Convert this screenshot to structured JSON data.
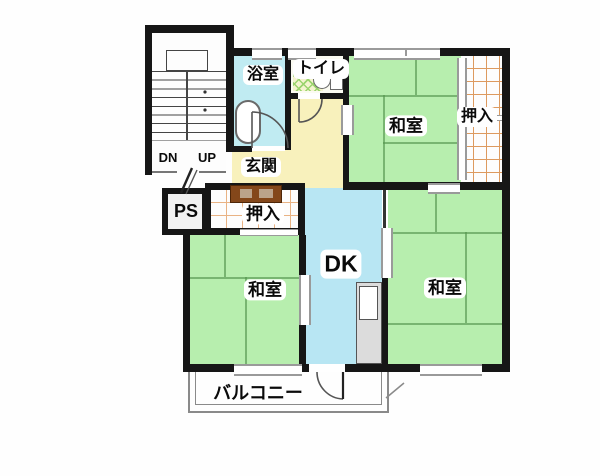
{
  "plan_title": "2DK apartment floor plan",
  "labels": {
    "bath": "浴室",
    "toilet": "トイレ",
    "washitsu_ne": "和室",
    "oshiire_ne": "押入",
    "genkan": "玄関",
    "dn": "DN",
    "up": "UP",
    "ps": "PS",
    "oshiire_mid": "押入",
    "dk": "DK",
    "washitsu_sw": "和室",
    "washitsu_se": "和室",
    "balcony": "バルコニー"
  },
  "colors": {
    "wall": "#161616",
    "tatami_green": "#b7eeae",
    "tatami_line": "#56964f",
    "bath_cyan": "#c0ebf2",
    "dk_cyan": "#b8e6f3",
    "hall_yellow": "#f8f1bc",
    "toilet_floor": "#f4f4cf",
    "toilet_lattice": "#9bd46e",
    "closet_grid_orange": "#dd9a5f",
    "balcony_gray": "#8a8a8a",
    "shoe_cabinet_brown": "#84471a"
  }
}
